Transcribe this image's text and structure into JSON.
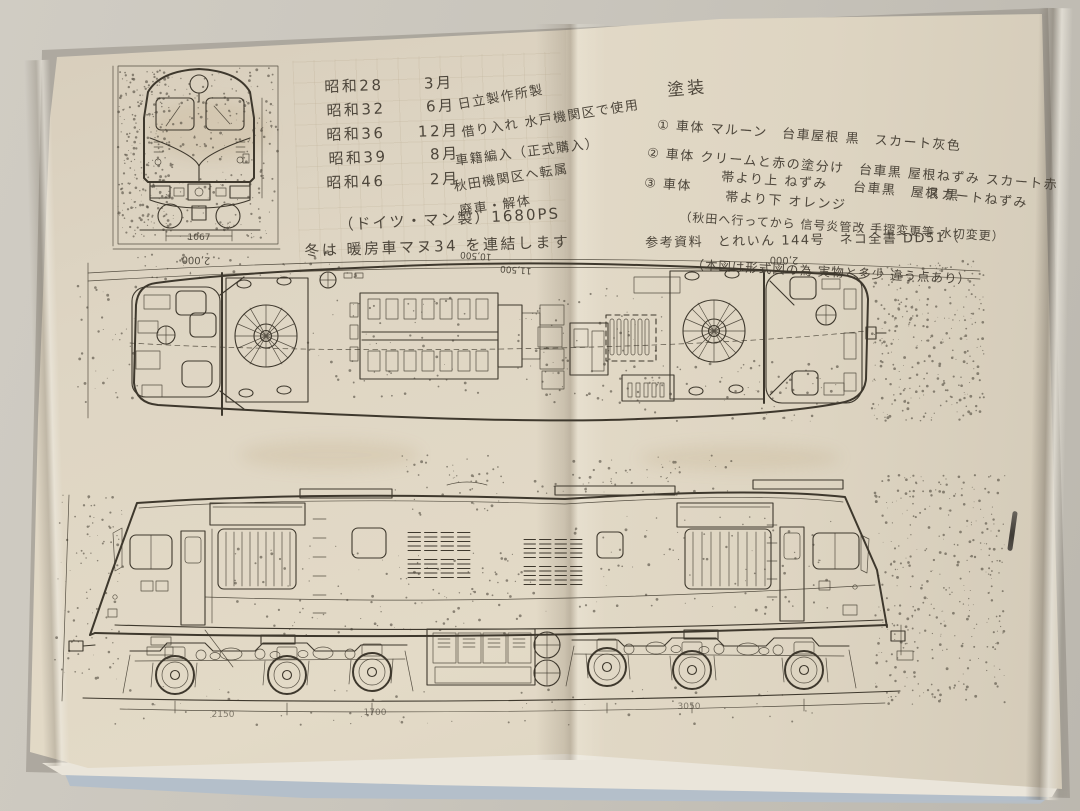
{
  "left_page": {
    "history": {
      "rows": [
        {
          "era": "昭和28",
          "month": "3月",
          "note": "日立製作所製"
        },
        {
          "era": "昭和32",
          "month": "6月",
          "note": "借り入れ 水戸機関区で使用"
        },
        {
          "era": "昭和36",
          "month": "12月",
          "note": "車籍編入（正式購入）"
        },
        {
          "era": "昭和39",
          "month": "8月",
          "note": "秋田機関区へ転属"
        },
        {
          "era": "昭和46",
          "month": "2月",
          "note": "廃車・解体"
        }
      ],
      "engine_line": "（ドイツ・マン製）1680PS",
      "winter_line": "冬は 暖房車マヌ34 を連結します"
    },
    "front_view": {
      "gauge_dim": "1067"
    }
  },
  "right_page": {
    "paint_section": {
      "title": "塗装",
      "item1": "① 車体 マルーン　台車屋根 黒　スカート灰色",
      "item2": "② 車体 クリームと赤の塗分け　台車黒 屋根ねずみ スカート赤",
      "item3_head": "③ 車体",
      "item3_upper": "帯より上 ねずみ",
      "item3_lower": "帯より下 オレンジ",
      "item3_cont": "台車黒　屋根 黒",
      "item3_end": "スカートねずみ",
      "note": "（秋田へ行ってから 信号炎管改 手摺変更等 水切変更）"
    },
    "reference": {
      "line1": "参考資料　とれいん 144号　ネコ全書 DD51（",
      "line2": "（本図は形式図の為 実物と多少 違う点あり）"
    }
  },
  "plan_view": {
    "dim_left": "2,000",
    "dim_top_inner": "10,500",
    "dim_top_outer": "11,500",
    "dim_right": "2,000"
  },
  "side_view": {
    "dim_1": "2150",
    "dim_2": "1700",
    "dim_3": "3050"
  }
}
